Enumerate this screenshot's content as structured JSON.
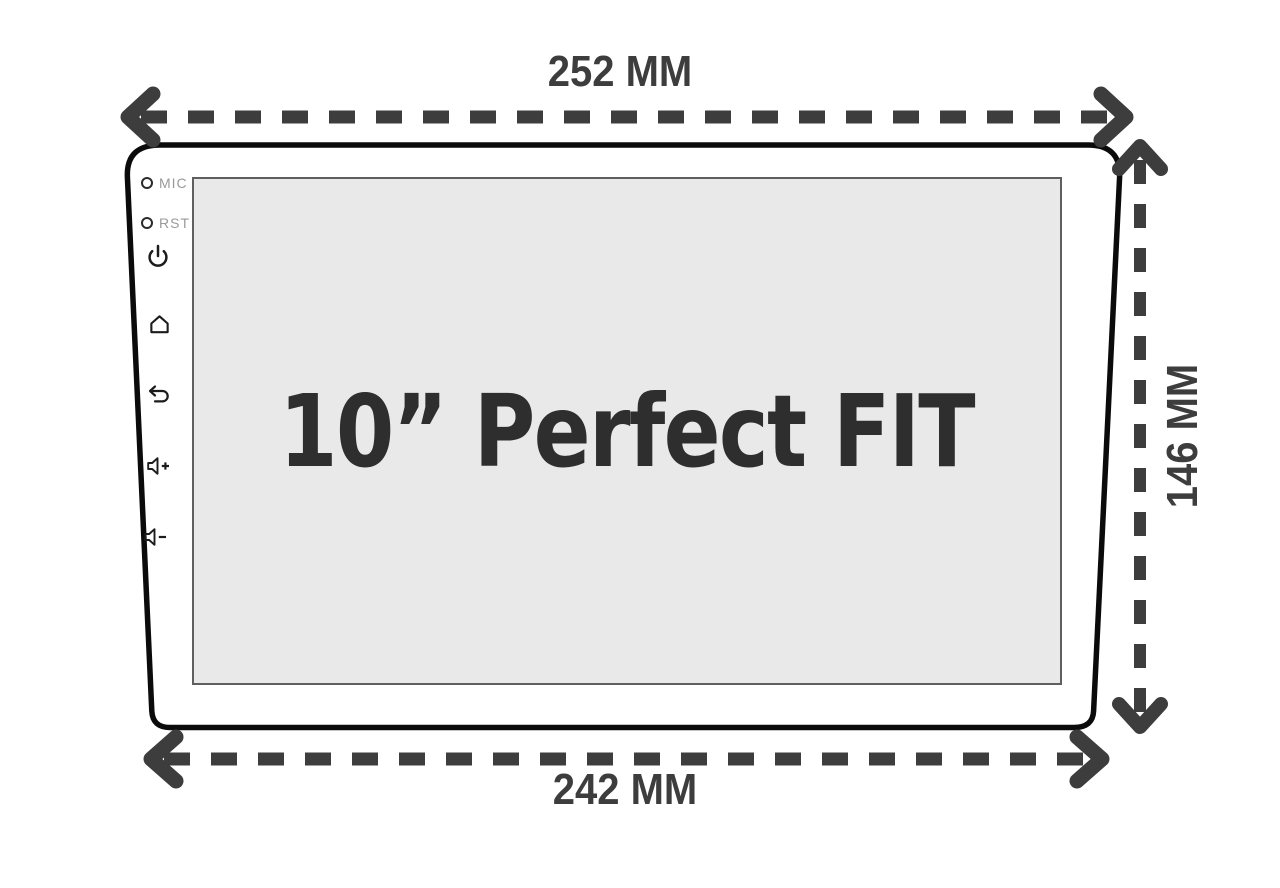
{
  "diagram": {
    "screen_title": "10” Perfect FIT",
    "dimensions": {
      "top_width": "252 MM",
      "bottom_width": "242 MM",
      "side_height": "146 MM"
    },
    "side_controls": {
      "mic_label": "MIC",
      "rst_label": "RST",
      "buttons": [
        {
          "name": "power",
          "icon": "power-icon"
        },
        {
          "name": "home",
          "icon": "home-icon"
        },
        {
          "name": "back",
          "icon": "back-icon"
        },
        {
          "name": "volume-up",
          "icon": "volume-up-icon"
        },
        {
          "name": "volume-down",
          "icon": "volume-down-icon"
        }
      ]
    },
    "colors": {
      "background": "#ffffff",
      "device_outline": "#0b0b0b",
      "arrow": "#3d3d3d",
      "screen_fill": "#e9e9e9",
      "screen_border": "#5f5f5f",
      "title_text": "#2e2e2e",
      "port_label": "#9a9a9a",
      "icon": "#1c1c1c"
    }
  }
}
